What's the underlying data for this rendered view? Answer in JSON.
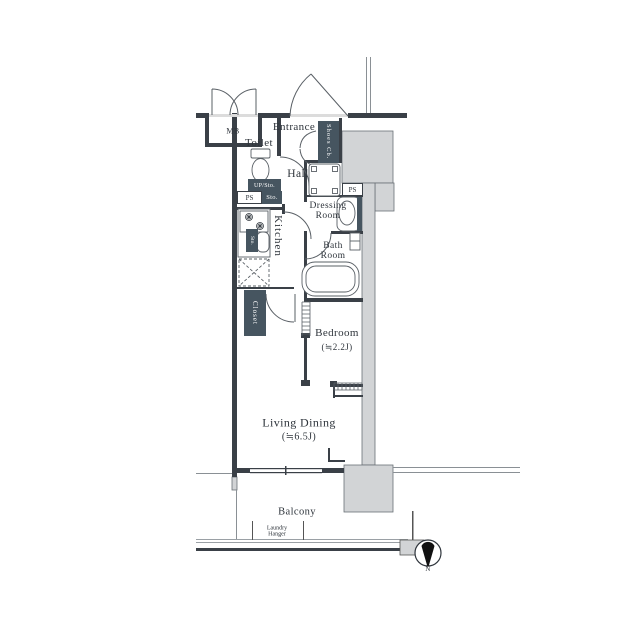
{
  "plan": {
    "rooms": {
      "entrance": {
        "label": "Entrance"
      },
      "hall": {
        "label": "Hall"
      },
      "toilet": {
        "label": "Toilet"
      },
      "kitchen": {
        "label": "Kitchen"
      },
      "dressing_room": {
        "line1": "Dressing",
        "line2": "Room"
      },
      "bath_room": {
        "line1": "Bath",
        "line2": "Room"
      },
      "bedroom": {
        "label": "Bedroom",
        "size": "(≒2.2J)"
      },
      "living_dining": {
        "label": "Living Dining",
        "size": "(≒6.5J)"
      },
      "balcony": {
        "label": "Balcony"
      }
    },
    "fixtures": {
      "meter_box": {
        "label": "MB"
      },
      "shoes_cabinet": {
        "label": "Shoes Cb."
      },
      "upper_storage": {
        "label": "UP/Sto."
      },
      "pipe_space_left": {
        "label": "PS"
      },
      "pipe_space_right": {
        "label": "PS"
      },
      "hall_storage": {
        "label": "Sto."
      },
      "kitchen_storage": {
        "label": "Sto."
      },
      "closet": {
        "label": "Closet"
      },
      "laundry_hanger": {
        "line1": "Laundry",
        "line2": "Hanger"
      }
    },
    "compass": {
      "north_label": "N"
    }
  },
  "colors": {
    "wall": "#3a4047",
    "badge": "#465560",
    "structure_fill": "#d2d4d6",
    "opening": "#dcdcdc",
    "text": "#2e343b",
    "background": "#ffffff"
  }
}
